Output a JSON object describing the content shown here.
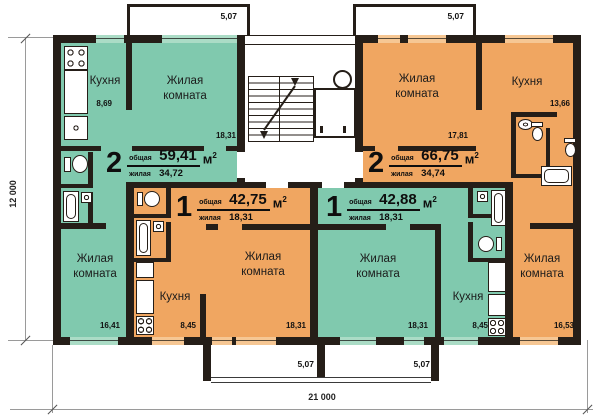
{
  "labels": {
    "total": "общая",
    "living": "жилая",
    "unit": "м",
    "unit_exp": "2"
  },
  "dimensions": {
    "building_width": "21 000",
    "building_height": "12 000"
  },
  "balconies": {
    "top_left": "5,07",
    "top_right": "5,07",
    "bottom_left": "5,07",
    "bottom_right": "5,07"
  },
  "apartments": {
    "left_two_room": {
      "number": "2",
      "total_area": "59,41",
      "living_area": "34,72",
      "kitchen": {
        "name": "Кухня",
        "area": "8,69"
      },
      "living_room_1": {
        "name": "Жилая комната",
        "area": "18,31"
      },
      "living_room_2": {
        "name": "Жилая комната",
        "area": "16,41"
      }
    },
    "right_two_room": {
      "number": "2",
      "total_area": "66,75",
      "living_area": "34,74",
      "living_room_1": {
        "name": "Жилая комната",
        "area": "17,81"
      },
      "kitchen": {
        "name": "Кухня",
        "area": "13,66"
      },
      "living_room_2": {
        "name": "Жилая комната",
        "area": "16,53"
      }
    },
    "left_one_room": {
      "number": "1",
      "total_area": "42,75",
      "living_area": "18,31",
      "kitchen": {
        "name": "Кухня",
        "area": "8,45"
      },
      "living_room": {
        "name": "Жилая комната",
        "area": "18,31"
      }
    },
    "right_one_room": {
      "number": "1",
      "total_area": "42,88",
      "living_area": "18,31",
      "living_room": {
        "name": "Жилая комната",
        "area": "18,31"
      },
      "kitchen": {
        "name": "Кухня",
        "area": "8,45"
      }
    }
  },
  "colors": {
    "wall": "#251e18",
    "green_fill": "#80c9ae",
    "green_window": "#abdcc6",
    "orange_fill": "#f0a661",
    "orange_window": "#f6c794",
    "dimension_line": "#9a9a9a"
  }
}
